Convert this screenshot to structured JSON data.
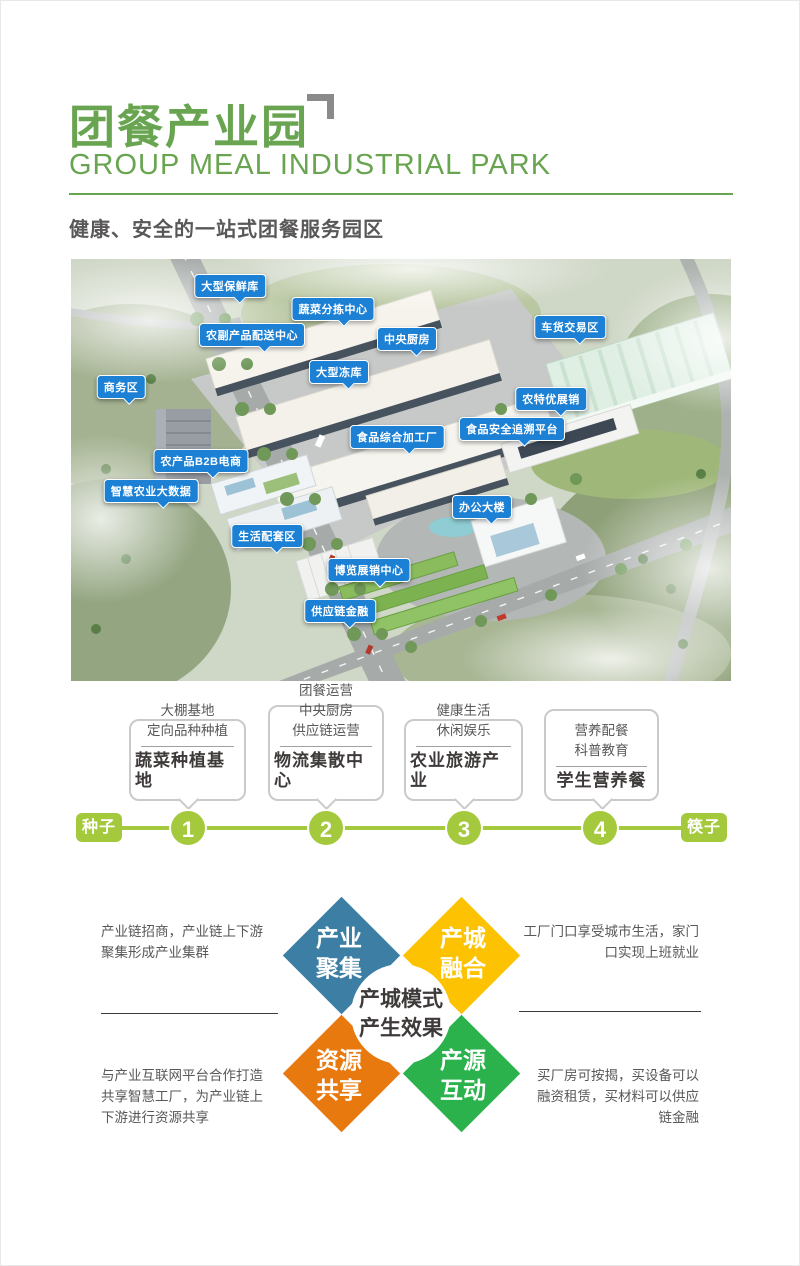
{
  "header": {
    "title": "团餐产业园",
    "subtitle": "GROUP MEAL INDUSTRIAL PARK",
    "tagline": "健康、安全的一站式团餐服务园区"
  },
  "map": {
    "labels": [
      {
        "text": "大型保鲜库"
      },
      {
        "text": "蔬菜分拣中心"
      },
      {
        "text": "农副产品配送中心"
      },
      {
        "text": "中央厨房"
      },
      {
        "text": "车货交易区"
      },
      {
        "text": "大型冻库"
      },
      {
        "text": "商务区"
      },
      {
        "text": "农特优展销"
      },
      {
        "text": "食品安全追溯平台"
      },
      {
        "text": "食品综合加工厂"
      },
      {
        "text": "农产品B2B电商"
      },
      {
        "text": "智慧农业大数据"
      },
      {
        "text": "办公大楼"
      },
      {
        "text": "生活配套区"
      },
      {
        "text": "博览展销中心"
      },
      {
        "text": "供应链金融"
      }
    ]
  },
  "timeline": {
    "start_label": "种子",
    "end_label": "筷子",
    "steps": [
      {
        "number": "1",
        "detail": "大棚基地\n定向品种种植",
        "title": "蔬菜种植基地"
      },
      {
        "number": "2",
        "detail": "团餐运营\n中央厨房\n供应链运营",
        "title": "物流集散中心"
      },
      {
        "number": "3",
        "detail": "健康生活\n休闲娱乐",
        "title": "农业旅游产业"
      },
      {
        "number": "4",
        "detail": "营养配餐\n科普教育",
        "title": "学生营养餐"
      }
    ]
  },
  "effects": {
    "center_text": "产城模式\n产生效果",
    "quadrants": [
      {
        "label": "产业聚集",
        "color": "#3d7fa4"
      },
      {
        "label": "产城融合",
        "color": "#fdc303"
      },
      {
        "label": "资源共享",
        "color": "#e8790f"
      },
      {
        "label": "产源互动",
        "color": "#2bb24c"
      }
    ],
    "notes": [
      {
        "text": "产业链招商，产业链上下游\n聚集形成产业集群"
      },
      {
        "text": "工厂门口享受城市生活，家门\n口实现上班就业"
      },
      {
        "text": "与产业互联网平台合作打造\n共享智慧工厂，为产业链上\n下游进行资源共享"
      },
      {
        "text": "买厂房可按揭，买设备可以\n融资租赁，买材料可以供应\n链金融"
      }
    ]
  },
  "colors": {
    "brand_green": "#69a551",
    "label_blue": "#1c80d4",
    "timeline_green": "#a4c93c",
    "text_dark": "#3e3a39",
    "text_gray": "#595757"
  }
}
